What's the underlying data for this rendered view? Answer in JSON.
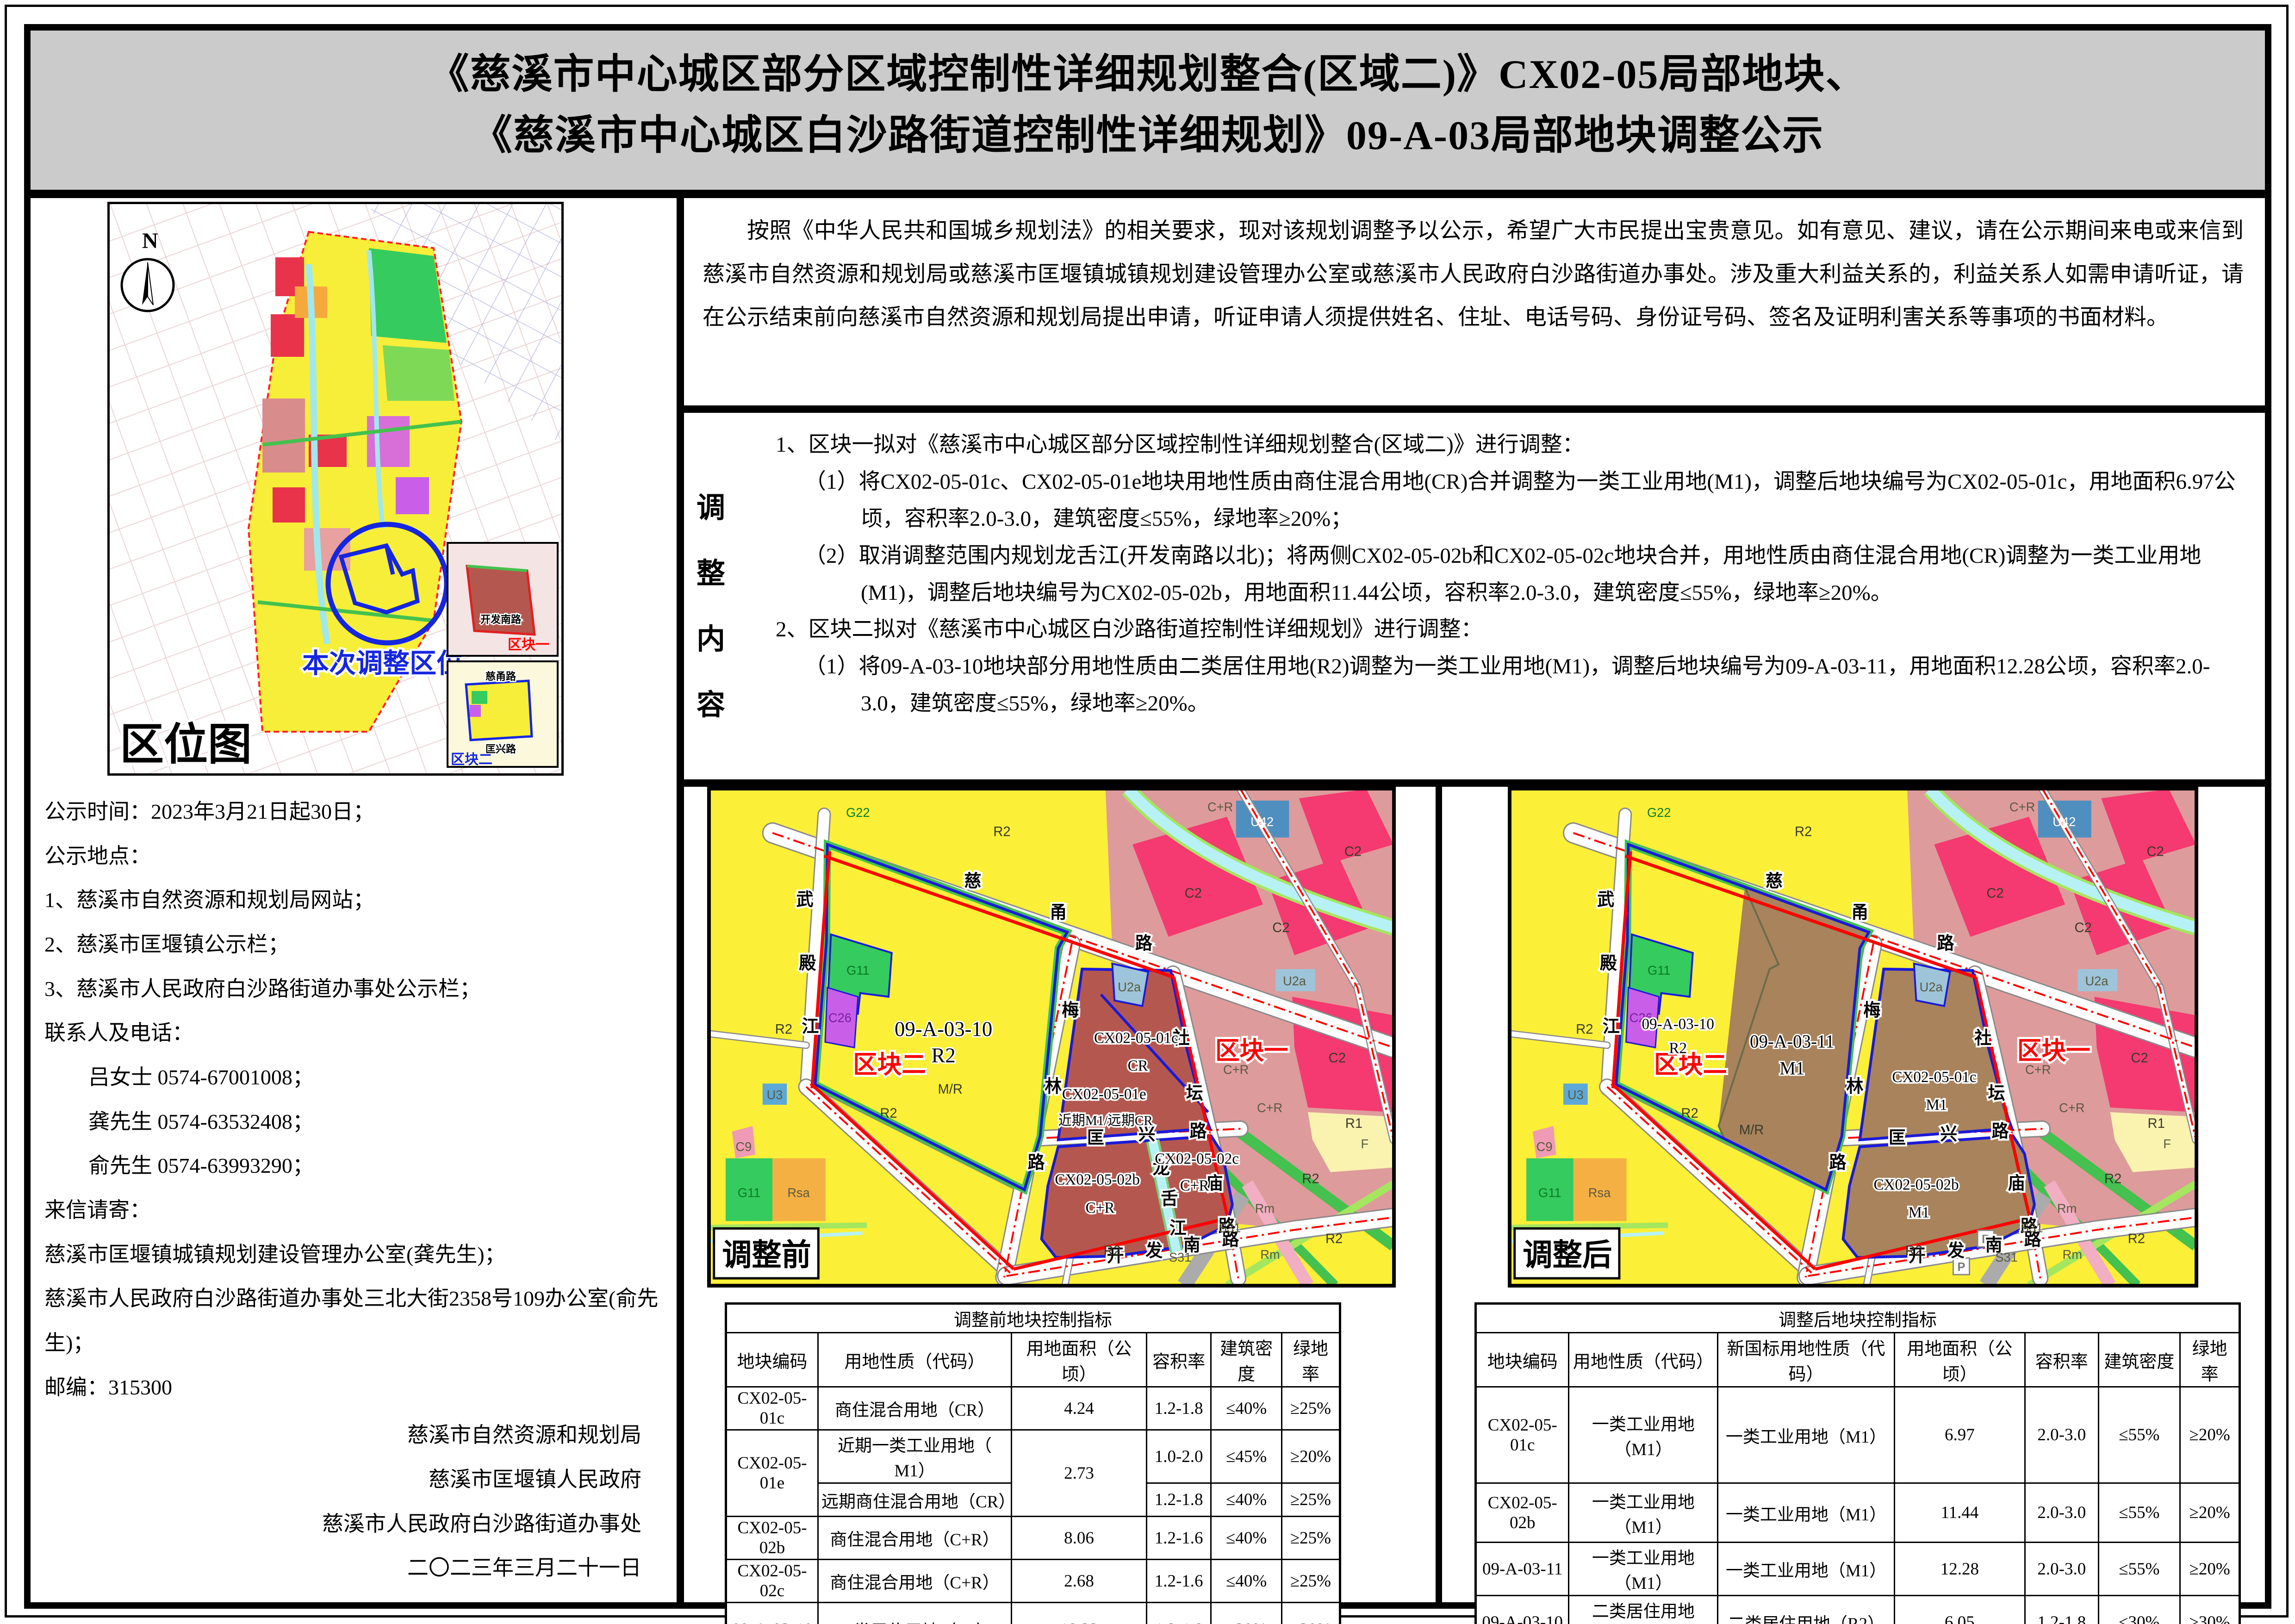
{
  "title": {
    "line1": "《慈溪市中心城区部分区域控制性详细规划整合(区域二)》CX02-05局部地块、",
    "line2": "《慈溪市中心城区白沙路街道控制性详细规划》09-A-03局部地块调整公示"
  },
  "notice_paragraph": "按照《中华人民共和国城乡规划法》的相关要求，现对该规划调整予以公示，希望广大市民提出宝贵意见。如有意见、建议，请在公示期间来电或来信到慈溪市自然资源和规划局或慈溪市匡堰镇城镇规划建设管理办公室或慈溪市人民政府白沙路街道办事处。涉及重大利益关系的，利益关系人如需申请听证，请在公示结束前向慈溪市自然资源和规划局提出申请，听证申请人须提供姓名、住址、电话号码、身份证号码、签名及证明利害关系等事项的书面材料。",
  "adjustment": {
    "side_label_chars": [
      "调",
      "整",
      "内",
      "容"
    ],
    "item1_head": "1、区块一拟对《慈溪市中心城区部分区域控制性详细规划整合(区域二)》进行调整：",
    "item1_1": "（1）将CX02-05-01c、CX02-05-01e地块用地性质由商住混合用地(CR)合并调整为一类工业用地(M1)，调整后地块编号为CX02-05-01c，用地面积6.97公顷，容积率2.0-3.0，建筑密度≤55%，绿地率≥20%；",
    "item1_2": "（2）取消调整范围内规划龙舌江(开发南路以北)；将两侧CX02-05-02b和CX02-05-02c地块合并，用地性质由商住混合用地(CR)调整为一类工业用地(M1)，调整后地块编号为CX02-05-02b，用地面积11.44公顷，容积率2.0-3.0，建筑密度≤55%，绿地率≥20%。",
    "item2_head": "2、区块二拟对《慈溪市中心城区白沙路街道控制性详细规划》进行调整：",
    "item2_1": "（1）将09-A-03-10地块部分用地性质由二类居住用地(R2)调整为一类工业用地(M1)，调整后地块编号为09-A-03-11，用地面积12.28公顷，容积率2.0-3.0，建筑密度≤55%，绿地率≥20%。"
  },
  "left_info": {
    "lines": [
      "公示时间：2023年3月21日起30日；",
      "公示地点：",
      "1、慈溪市自然资源和规划局网站；",
      "2、慈溪市匡堰镇公示栏；",
      "3、慈溪市人民政府白沙路街道办事处公示栏；",
      "联系人及电话：",
      "吕女士 0574-67001008；",
      "龚先生 0574-63532408；",
      "俞先生 0574-63993290；",
      "来信请寄：",
      "慈溪市匡堰镇城镇规划建设管理办公室(龚先生)；",
      "慈溪市人民政府白沙路街道办事处三北大街2358号109办公室(俞先生)；",
      "邮编：315300"
    ],
    "signatures": [
      "慈溪市自然资源和规划局",
      "慈溪市匡堰镇人民政府",
      "慈溪市人民政府白沙路街道办事处",
      "二〇二三年三月二十一日"
    ]
  },
  "location_map": {
    "label": "区位图",
    "north": "N",
    "highlight": "本次调整区位",
    "inset1_label": "区块一",
    "inset1_road": "开发南路",
    "inset2_label": "区块二",
    "inset2_roads": [
      "慈甬路",
      "匡兴路"
    ]
  },
  "before_map": {
    "corner": "调整前",
    "road_ciyong": [
      "慈",
      "甬",
      "路"
    ],
    "road_wudian": [
      "武",
      "殿",
      "江"
    ],
    "road_meilin": [
      "梅",
      "林",
      "路"
    ],
    "road_kuangxing": [
      "匡",
      "兴",
      "路"
    ],
    "road_shetan": [
      "社",
      "坛",
      "庙",
      "路"
    ],
    "road_kaifa": [
      "开",
      "发",
      "南",
      "路"
    ],
    "river_longshe": [
      "龙",
      "舌",
      "江"
    ],
    "block1": "区块一",
    "block2": "区块二",
    "labels": {
      "g22": "G22",
      "r2_top": "R2",
      "cr_ne": "C+R",
      "u42": "U42",
      "c2_1": "C2",
      "c2_2": "C2",
      "c2_3": "C2",
      "u2a_ne": "U2a",
      "r2_left": "R2",
      "g11_big": "G11",
      "c26": "C26",
      "big_code": "09-A-03-10",
      "big_use": "R2",
      "u3": "U3",
      "mr": "M/R",
      "r2_mid": "R2",
      "u2a_top": "U2a",
      "c01c": "CX02-05-01c",
      "c01c_use": "CR",
      "c01e": "CX02-05-01e",
      "c01e_use": "近期M1/远期CR",
      "cr_e": "C+R",
      "c2_e": "C2",
      "r1_e": "R1",
      "c02b": "CX02-05-02b",
      "c02b_use": "C+R",
      "c02c": "CX02-05-02c",
      "c02c_use": "C+R",
      "cr_se": "C+R",
      "f_se": "F",
      "r2_se": "R2",
      "rm_1": "Rm",
      "s31_1": "S31",
      "r2_s": "R2",
      "s31_2": "S31",
      "rm_2": "Rm",
      "r2_b": "R2",
      "c9": "C9",
      "g11_sw": "G11",
      "rsa": "Rsa"
    }
  },
  "after_map": {
    "corner": "调整后",
    "road_ciyong": [
      "慈",
      "甬",
      "路"
    ],
    "road_wudian": [
      "武",
      "殿",
      "江"
    ],
    "road_meilin": [
      "梅",
      "林",
      "路"
    ],
    "road_kuangxing": [
      "匡",
      "兴",
      "路"
    ],
    "road_shetan": [
      "社",
      "坛",
      "庙",
      "路"
    ],
    "road_kaifa": [
      "开",
      "发",
      "南",
      "路"
    ],
    "block1": "区块一",
    "block2": "区块二",
    "p_icon": "P",
    "labels": {
      "g22": "G22",
      "r2_top": "R2",
      "cr_ne": "C+R",
      "u42": "U42",
      "c2_1": "C2",
      "c2_2": "C2",
      "c2_3": "C2",
      "u2a_ne": "U2a",
      "r2_left": "R2",
      "g11_big": "G11",
      "c26": "C26",
      "old_code": "09-A-03-10",
      "old_use": "R2",
      "new_code": "09-A-03-11",
      "new_use": "M1",
      "u3": "U3",
      "mr": "M/R",
      "r2_mid": "R2",
      "u2a_top": "U2a",
      "c01c": "CX02-05-01c",
      "c01c_use": "M1",
      "cr_e": "C+R",
      "c2_e": "C2",
      "r1_e": "R1",
      "c02b": "CX02-05-02b",
      "c02b_use": "M1",
      "cr_se": "C+R",
      "f_se": "F",
      "r2_se": "R2",
      "rm_1": "Rm",
      "s31_1": "S31",
      "r2_s": "R2",
      "s31_2": "S31",
      "rm_2": "Rm",
      "r2_b": "R2",
      "c9": "C9",
      "g11_sw": "G11",
      "rsa": "Rsa"
    }
  },
  "before_table": {
    "title": "调整前地块控制指标",
    "headers": [
      "地块编码",
      "用地性质（代码）",
      "用地面积（公顷）",
      "容积率",
      "建筑密度",
      "绿地率"
    ],
    "rows": {
      "r1": [
        "CX02-05-01c",
        "商住混合用地（CR）",
        "4.24",
        "1.2-1.8",
        "≤40%",
        "≥25%"
      ],
      "r2_code": "CX02-05-01e",
      "r2_area": "2.73",
      "r2a": [
        "近期一类工业用地（ M1）",
        "1.0-2.0",
        "≤45%",
        "≥20%"
      ],
      "r2b": [
        "远期商住混合用地（CR）",
        "1.2-1.8",
        "≤40%",
        "≥25%"
      ],
      "r3": [
        "CX02-05-02b",
        "商住混合用地（C+R）",
        "8.06",
        "1.2-1.6",
        "≤40%",
        "≥25%"
      ],
      "r4": [
        "CX02-05-02c",
        "商住混合用地（C+R）",
        "2.68",
        "1.2-1.6",
        "≤40%",
        "≥25%"
      ],
      "r5": [
        "09-A-03-10",
        "二类居住用地（R2）",
        "18.33",
        "1.2-1.8",
        "≤30%",
        "≥30%"
      ]
    }
  },
  "after_table": {
    "title": "调整后地块控制指标",
    "headers": [
      "地块编码",
      "用地性质（代码）",
      "新国标用地性质（代码）",
      "用地面积（公顷）",
      "容积率",
      "建筑密度",
      "绿地率"
    ],
    "rows": {
      "r1": [
        "CX02-05-01c",
        "一类工业用地（M1）",
        "一类工业用地（M1）",
        "6.97",
        "2.0-3.0",
        "≤55%",
        "≥20%"
      ],
      "r2": [
        "CX02-05-02b",
        "一类工业用地（M1）",
        "一类工业用地（M1）",
        "11.44",
        "2.0-3.0",
        "≤55%",
        "≥20%"
      ],
      "r3": [
        "09-A-03-11",
        "一类工业用地（M1）",
        "一类工业用地（M1）",
        "12.28",
        "2.0-3.0",
        "≤55%",
        "≥20%"
      ],
      "r4": [
        "09-A-03-10",
        "二类居住用地（R2）",
        "二类居住用地（R2）",
        "6.05",
        "1.2-1.8",
        "≤30%",
        "≥30%"
      ]
    }
  },
  "colors": {
    "title_bg": "#CBCBCB",
    "boundary_red": "#FF0000",
    "parcel_outline_blue": "#1A1AD8",
    "residential_yellow": "#FBEF37",
    "cr_brick": "#B4584F",
    "m1_brown": "#A8835C",
    "c2_crimson": "#F43A70",
    "cplusr_pink": "#DE9B9B",
    "green_g11": "#35CB5E",
    "water_cyan": "#B6F2F5",
    "u2a_blue": "#9EC4D9",
    "rsa_orange": "#F5B043",
    "s31_grey": "#ABABAB"
  }
}
